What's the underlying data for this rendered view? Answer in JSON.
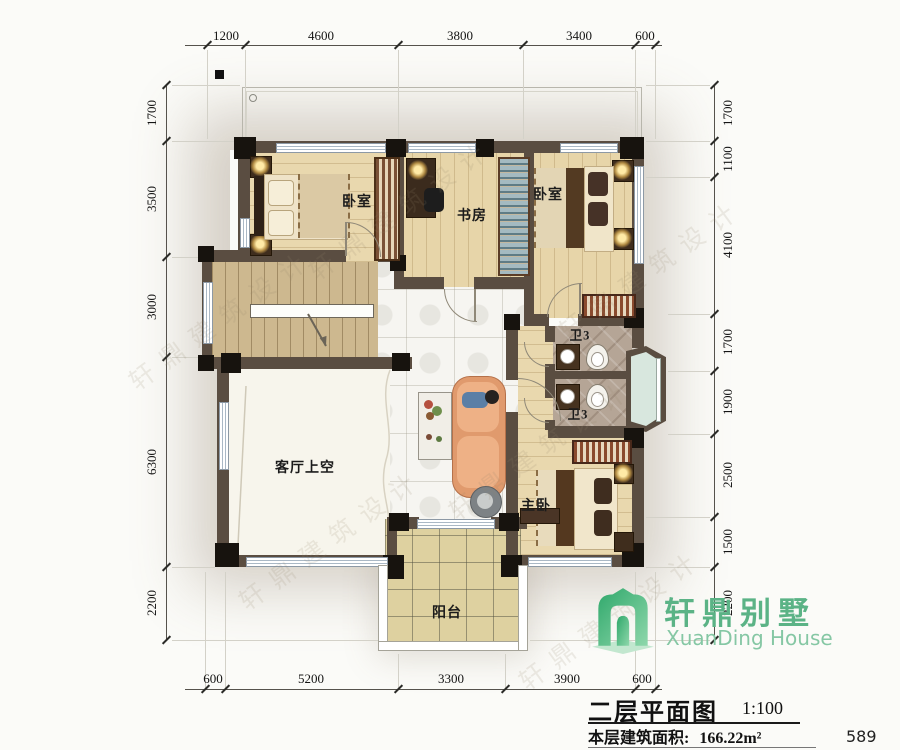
{
  "watermark": "轩鼎建筑设计",
  "dims": {
    "top": [
      "1200",
      "4600",
      "3800",
      "3400",
      "600"
    ],
    "bottom": [
      "600",
      "5200",
      "3300",
      "3900",
      "600"
    ],
    "left": [
      "1700",
      "3500",
      "3000",
      "6300",
      "2200"
    ],
    "right": [
      "1700",
      "1100",
      "4100",
      "1700",
      "1900",
      "2500",
      "1500",
      "2200"
    ]
  },
  "rooms": {
    "bedroom_left": "卧室",
    "study": "书房",
    "bedroom_right": "卧室",
    "bath_upper": "卫3",
    "bath_lower": "卫3",
    "living_void": "客厅上空",
    "master": "主卧",
    "balcony": "阳台"
  },
  "title_block": {
    "title": "二层平面图",
    "scale": "1:100",
    "area_label": "本层建筑面积:",
    "area_value": "166.22m²",
    "page_number": "589"
  },
  "logo": {
    "name_cn": "轩鼎别墅",
    "name_en": "XuanDing House"
  },
  "colors": {
    "wall": "#5a4d41",
    "column": "#17130e",
    "wood_floor": "#e9d8ae",
    "hall_tile": "#f6f5f1",
    "bath_stone": "#b5a596",
    "balcony_tile": "#ded1a0",
    "logo_green": "#5bb386"
  }
}
